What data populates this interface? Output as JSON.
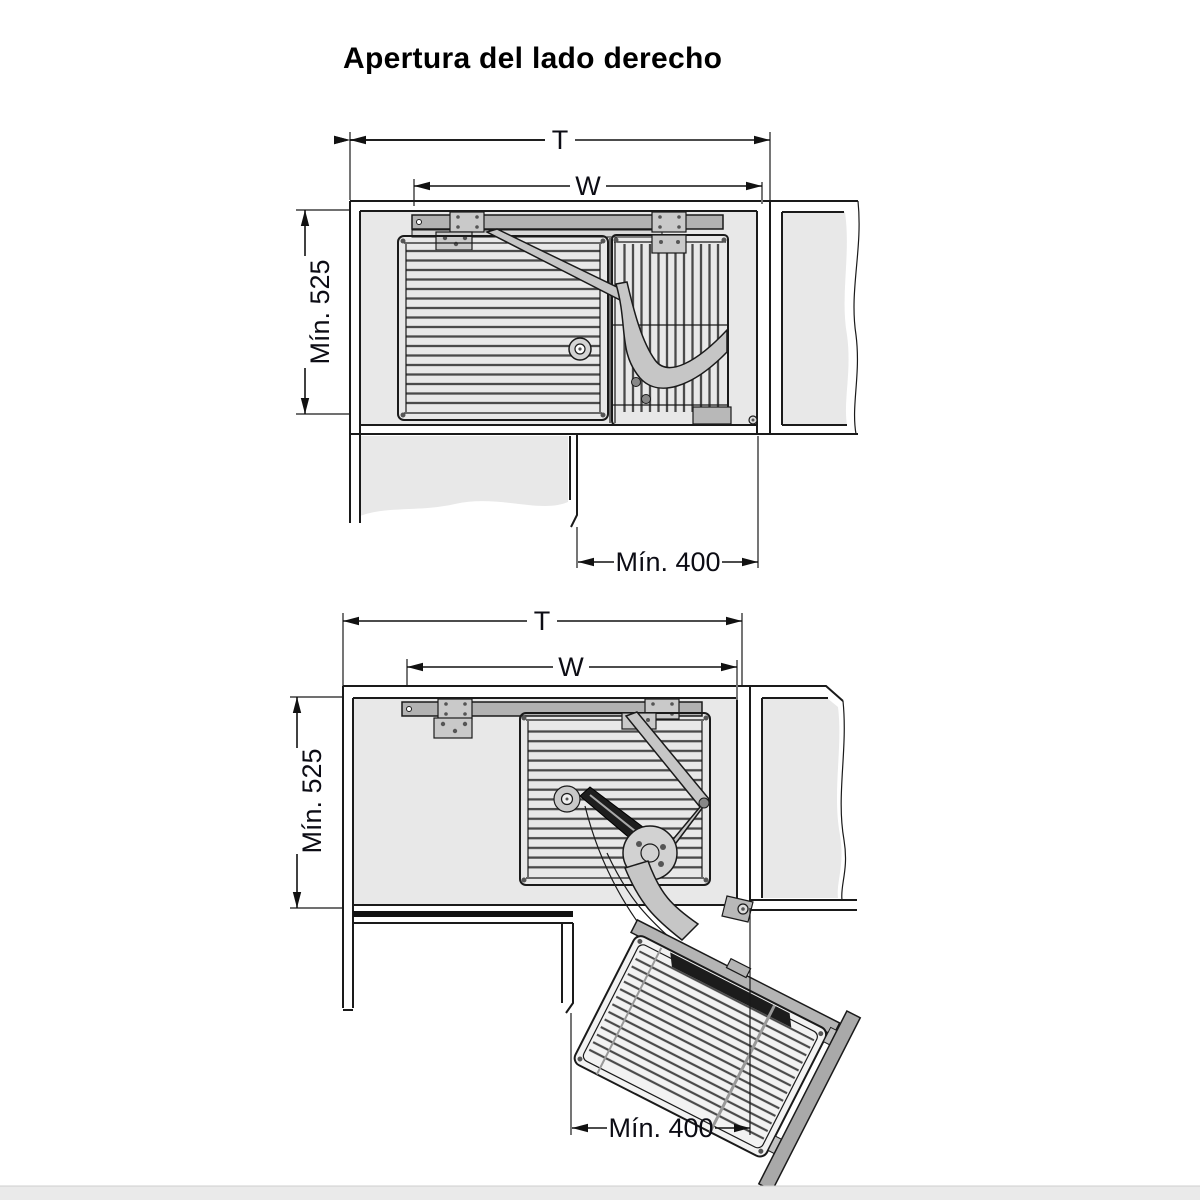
{
  "title": "Apertura del lado derecho",
  "colors": {
    "background": "#ffffff",
    "cabinet_fill": "#e8e8e8",
    "hardware_gray": "#b2b2b2",
    "line": "#1a1a1a"
  },
  "diagrams": [
    {
      "name": "closed-position",
      "description": "top view, basket stored inside corner cabinet",
      "dims": {
        "total_width": "T",
        "runner_width": "W",
        "min_depth": "Mín. 525",
        "min_opening": "Mín. 400"
      }
    },
    {
      "name": "open-position",
      "description": "top view, basket swung out through door opening",
      "dims": {
        "total_width": "T",
        "runner_width": "W",
        "min_depth": "Mín. 525",
        "min_opening": "Mín. 400"
      }
    }
  ]
}
